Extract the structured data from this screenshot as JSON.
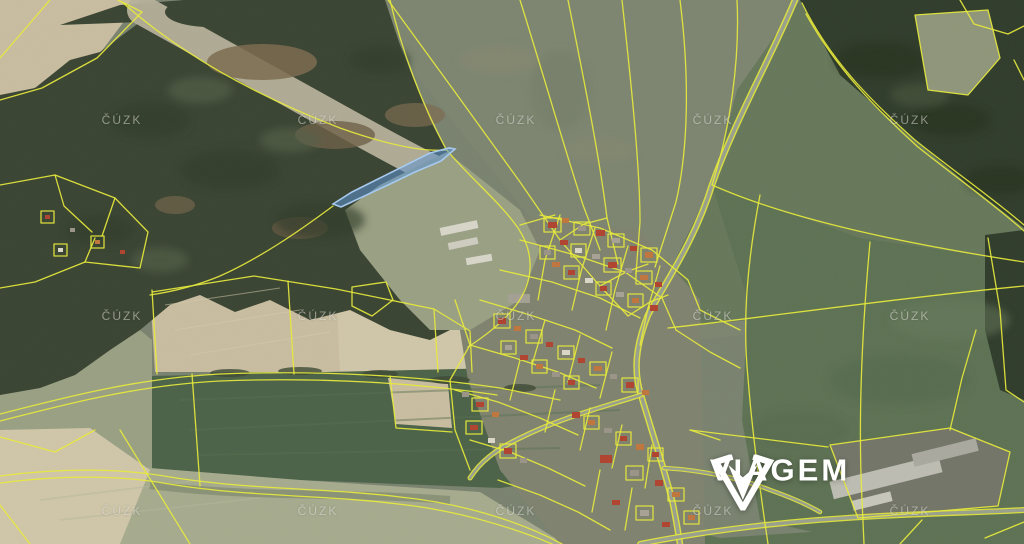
{
  "watermark": {
    "text": "ČÚZK",
    "color": "rgba(235,235,228,0.5)",
    "grid_x": [
      122,
      318,
      516,
      713,
      910
    ],
    "grid_y": [
      120,
      316,
      511
    ]
  },
  "branding": {
    "wordmark": "VIAGEM",
    "color": "#ffffff"
  },
  "highlight_parcel": {
    "fill": "#5e95d4",
    "fill_opacity": 0.55,
    "stroke": "#a6c9ee"
  },
  "cadastre": {
    "line_color": "#e6e93d"
  },
  "terrain_colors": {
    "base": "#7a8370",
    "field_grey_green": "#7d8671",
    "field_green": "#5e7254",
    "field_green_light": "#67785b",
    "field_green_dark": "#4c6349",
    "field_tan": "#c9bda0",
    "field_tan_light": "#d0c6a9",
    "field_khaki": "#a6ab8e",
    "meadow_pale": "#b6b19b",
    "scrub": "#9aa083",
    "forest": "#3b4533",
    "forest_dark": "#313d2c",
    "village_base": "#7f836f",
    "road": "#9aa08e"
  }
}
